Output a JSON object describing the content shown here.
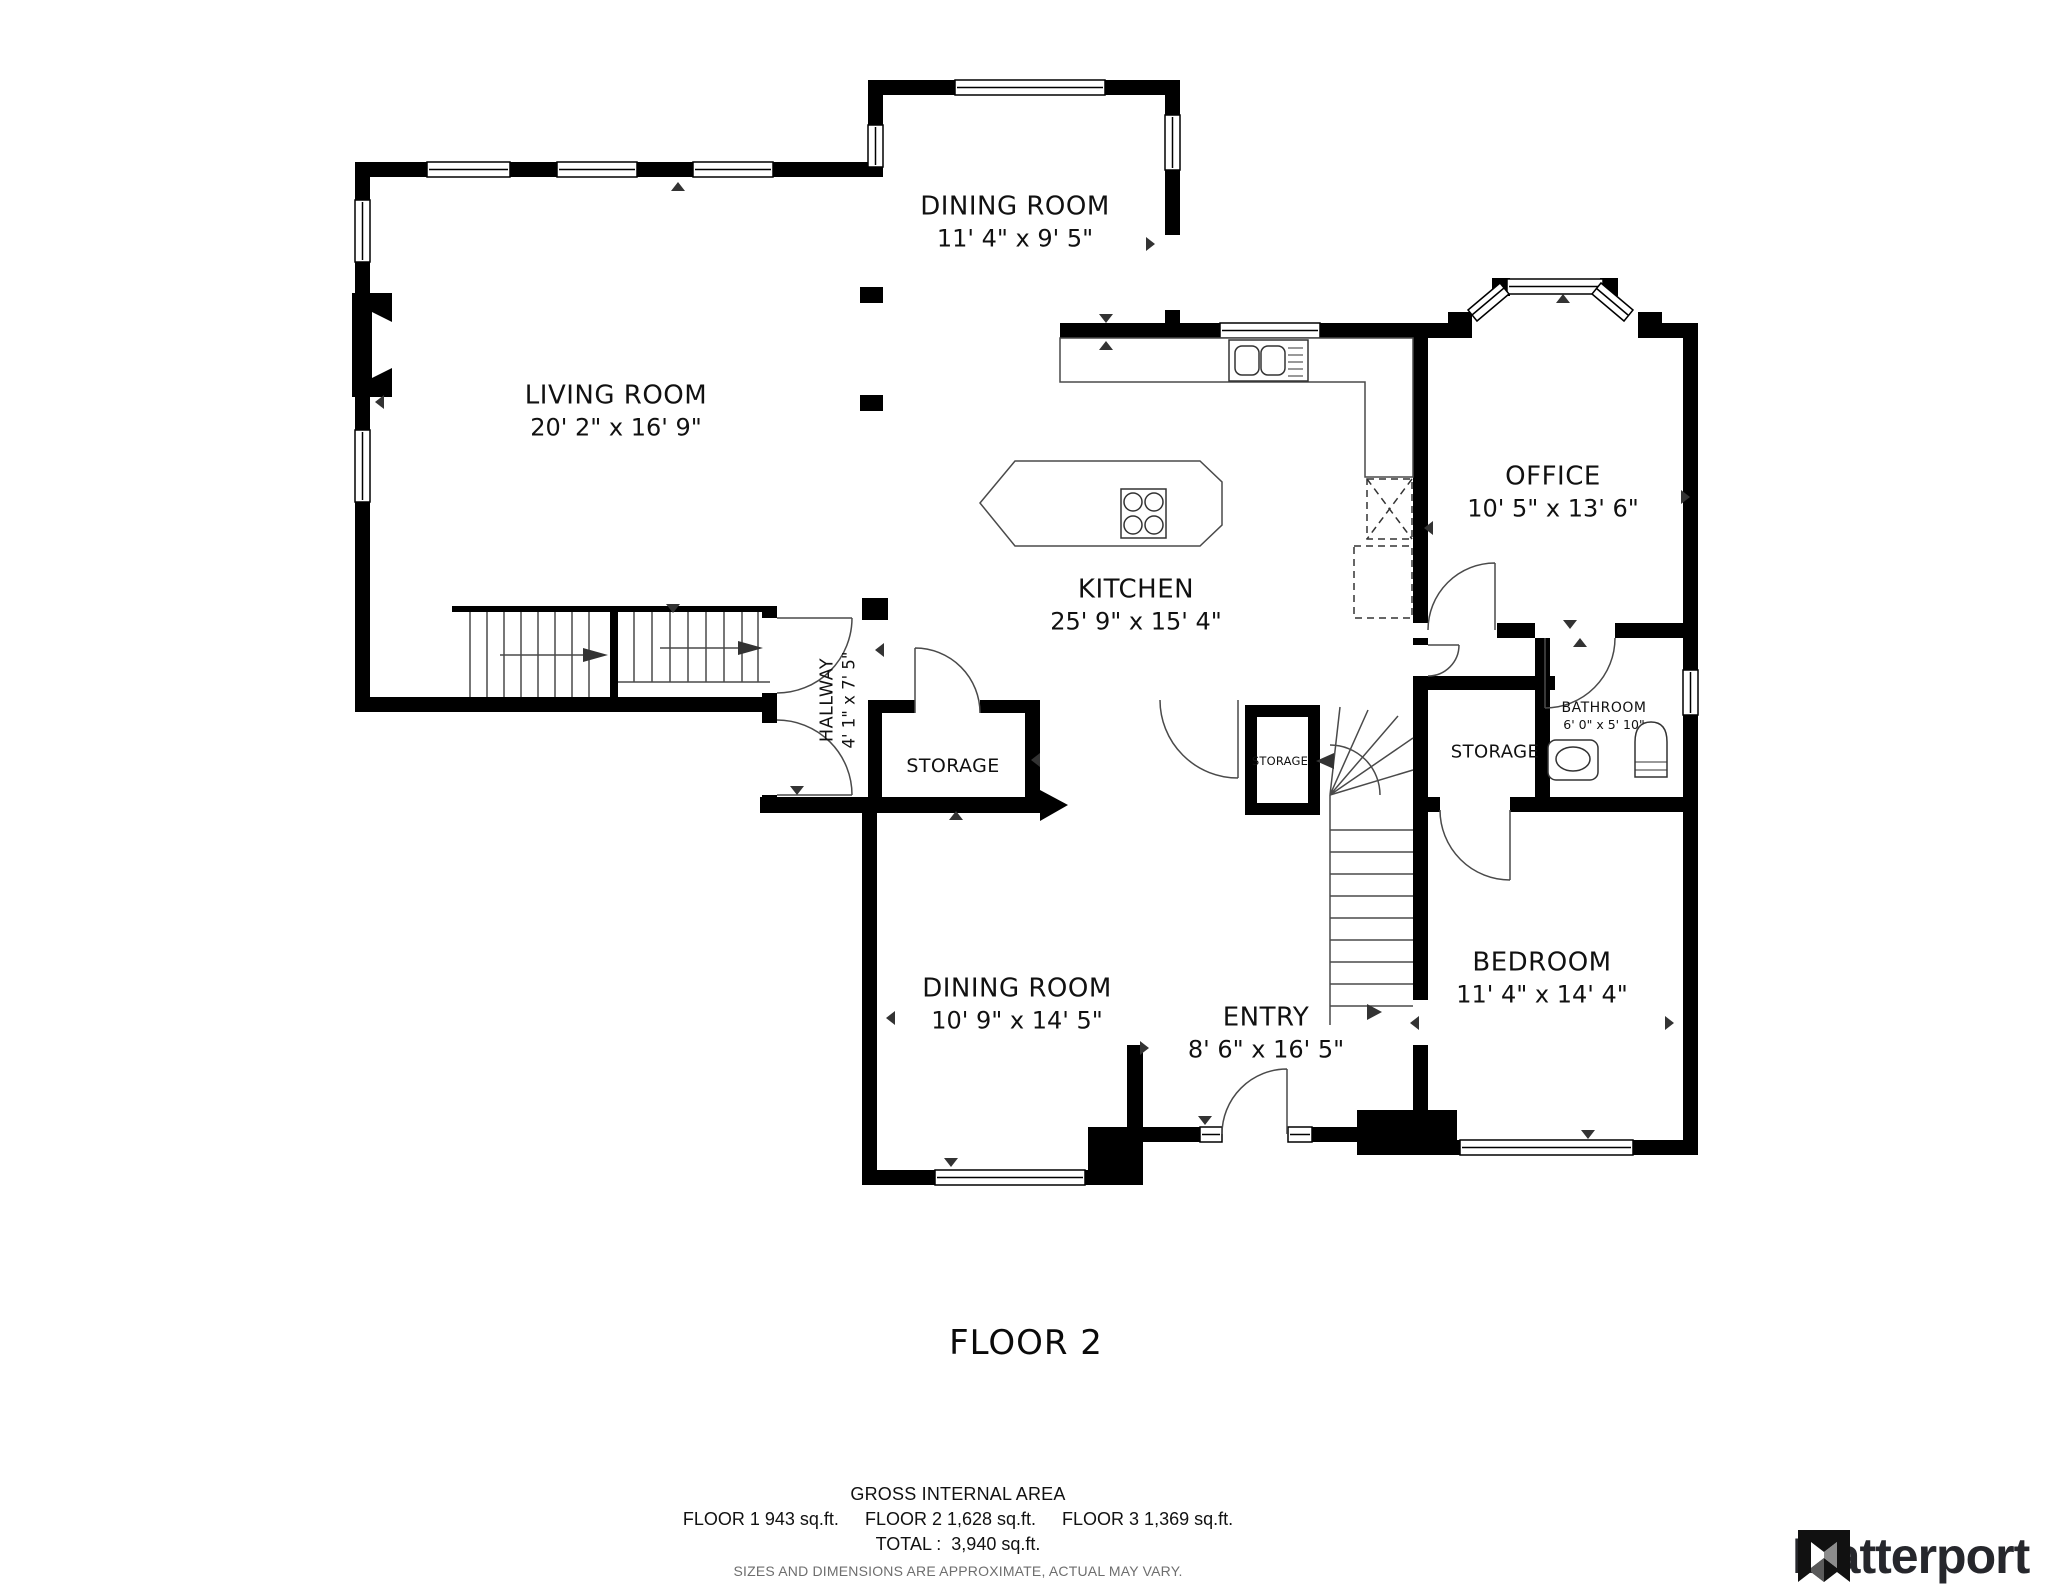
{
  "plan": {
    "floor_label": "FLOOR 2",
    "rooms": {
      "dining_top": {
        "name": "DINING ROOM",
        "dims": "11' 4\" x 9' 5\""
      },
      "living": {
        "name": "LIVING ROOM",
        "dims": "20' 2\" x 16' 9\""
      },
      "office": {
        "name": "OFFICE",
        "dims": "10' 5\" x 13' 6\""
      },
      "kitchen": {
        "name": "KITCHEN",
        "dims": "25' 9\" x 15' 4\""
      },
      "hallway": {
        "name": "HALLWAY",
        "dims": "4' 1\" x 7' 5\""
      },
      "storage_left": {
        "name": "STORAGE"
      },
      "storage_small": {
        "name": "STORAGE"
      },
      "storage_right": {
        "name": "STORAGE"
      },
      "bathroom": {
        "name": "BATHROOM",
        "dims": "6' 0\" x 5' 10\""
      },
      "bedroom": {
        "name": "BEDROOM",
        "dims": "11' 4\" x 14' 4\""
      },
      "entry": {
        "name": "ENTRY",
        "dims": "8' 6\" x 16' 5\""
      },
      "dining_bottom": {
        "name": "DINING ROOM",
        "dims": "10' 9\" x 14' 5\""
      }
    }
  },
  "footer": {
    "gross_title": "GROSS INTERNAL AREA",
    "floors": [
      "FLOOR 1 943 sq.ft.",
      "FLOOR 2 1,628 sq.ft.",
      "FLOOR 3 1,369 sq.ft."
    ],
    "total_line": "TOTAL :  3,940 sq.ft.",
    "disclaimer": "SIZES AND DIMENSIONS ARE APPROXIMATE, ACTUAL MAY VARY."
  },
  "brand": {
    "name": "Matterport",
    "mark_icon": "matterport-mark-icon"
  },
  "colors": {
    "wall": "#000000",
    "line": "#4a4a4a",
    "label": "#111111",
    "muted": "#6e6e6e",
    "brand_text": "#26272c",
    "bg": "#ffffff"
  }
}
